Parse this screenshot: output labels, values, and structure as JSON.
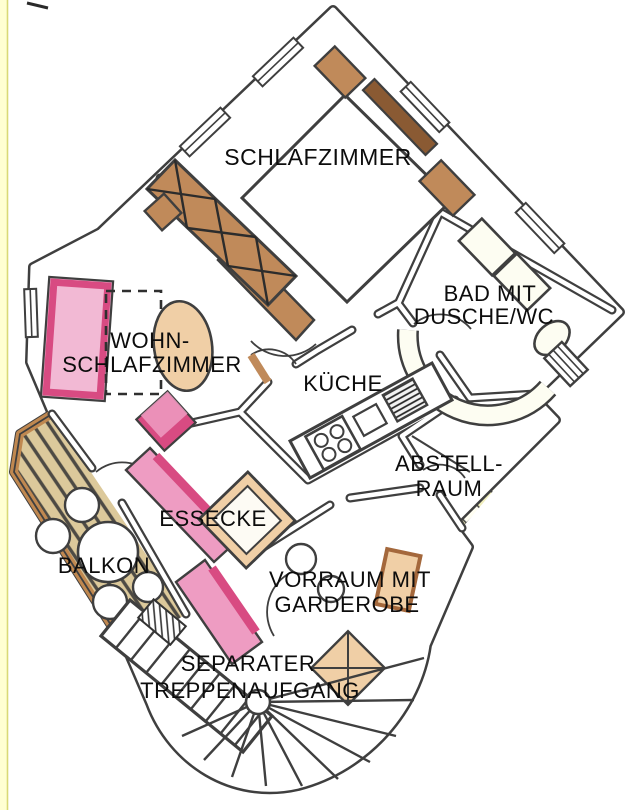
{
  "title": "Hand-drawn apartment floor plan",
  "palette": {
    "wall": "#3f3f3f",
    "text": "#0c0c0c",
    "margin_stripe": "#ffffd2",
    "margin_line": "#d9d977",
    "bedroom_floor": "#d9ecd3",
    "bath_tile": "#e09a5d",
    "bath_tile_streak": "#d4854a",
    "bath_tile_line": "#3c2b17",
    "kitchen_floor": "#e7f0f4",
    "storage_tile": "#f0eebd",
    "hall_floor": "#faf4da",
    "balcony_deck": "#dcc99b",
    "balcony_stripe": "#4d4a44",
    "balcony_rail": "#c08850",
    "wood": "#c08a5a",
    "wood_dark": "#8a5a33",
    "wood_light": "#f0cfa6",
    "pink_dark": "#d84b82",
    "pink_light": "#f2b9d4",
    "pink_mid": "#ee9cc2",
    "fixture": "#fdfdf2"
  },
  "rooms": {
    "schlafzimmer": {
      "label": "SCHLAFZIMMER"
    },
    "bad": {
      "line1": "BAD MIT",
      "line2": "DUSCHE/WC"
    },
    "wohn": {
      "line1": "WOHN-",
      "line2": "SCHLAFZIMMER"
    },
    "kueche": {
      "label": "KÜCHE"
    },
    "abstellraum": {
      "line1": "ABSTELL-",
      "line2": "RAUM"
    },
    "essecke": {
      "label": "ESSECKE"
    },
    "balkon": {
      "label": "BALKON"
    },
    "vorraum": {
      "line1": "VORRAUM MIT",
      "line2": "GARDEROBE"
    },
    "treppe": {
      "line1": "SEPARATER",
      "line2": "TREPPENAUFGANG"
    }
  }
}
